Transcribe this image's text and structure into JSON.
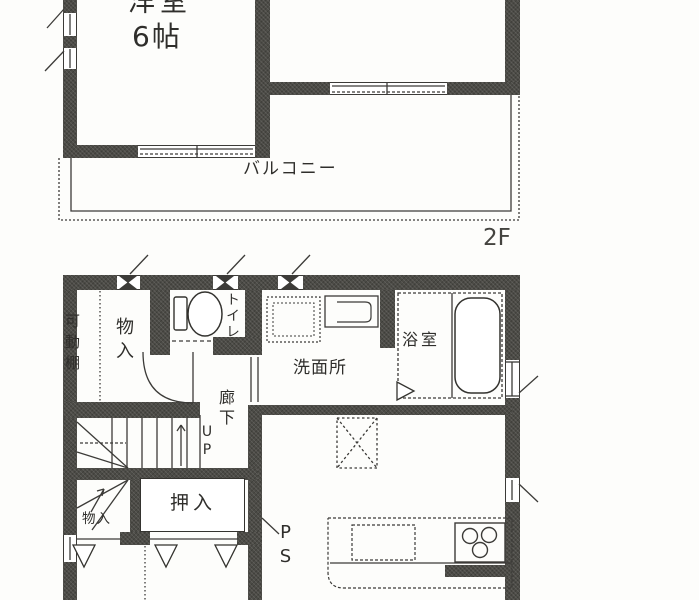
{
  "meta": {
    "type": "japanese-floor-plan",
    "floors_shown": [
      "2F",
      "1F"
    ]
  },
  "colors": {
    "wall": "#4c4b46",
    "line": "#3c3b38",
    "background": "#fdfdfb"
  },
  "labels": {
    "western_room": "洋室",
    "western_room_size": "6帖",
    "balcony": "バルコニー",
    "floor_2f": "2F",
    "movable_shelf": "可動棚",
    "storage_upper": "物入",
    "toilet": "トイレ",
    "washroom": "洗面所",
    "bathroom": "浴室",
    "corridor": "廊下",
    "stairs_up": "UP",
    "storage_under_stairs": "物入",
    "closet": "押入",
    "pipe_space": "PS"
  },
  "icons": {
    "toilet": "toilet-fixture-icon",
    "bathtub": "bathtub-icon",
    "washbasin": "washbasin-icon",
    "washing_machine_pan": "washing-machine-pan-icon",
    "refrigerator_space": "refrigerator-space-icon",
    "kitchen_sink": "kitchen-sink-icon",
    "stove": "stove-burners-icon",
    "door": "hinged-door-arc-icon",
    "stairs": "staircase-icon"
  }
}
